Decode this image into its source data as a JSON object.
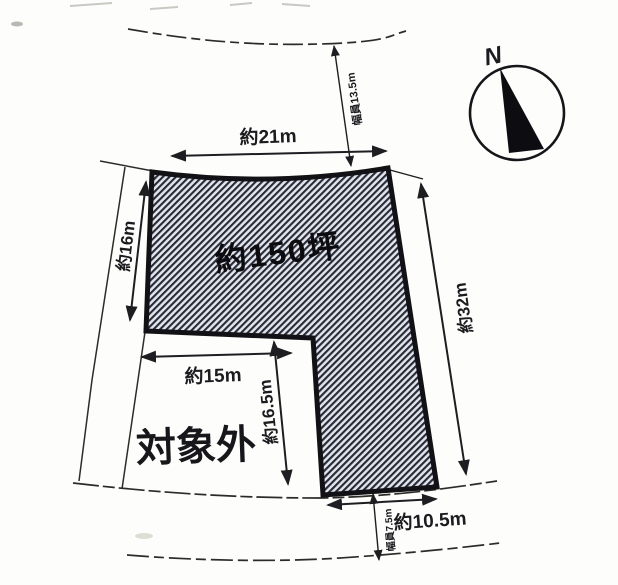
{
  "diagram_title": "land-plot-survey-diagram",
  "compass": {
    "north_label": "N"
  },
  "plot": {
    "area_label": "約150坪",
    "excluded_label": "対象外"
  },
  "dimensions": {
    "top_width": "約21m",
    "left_side": "約16m",
    "right_side": "約32m",
    "inner_width": "約15m",
    "inner_height": "約16.5m",
    "bottom_width": "約10.5m",
    "top_road_width": "幅員13.5m",
    "bottom_road_width": "幅員7.5m"
  },
  "colors": {
    "ink": "#1c1c20",
    "plot_outline": "#121216",
    "hatch_line": "#252a38",
    "hatch_background": "#e2e4e9",
    "paper": "#fdfdfb"
  }
}
